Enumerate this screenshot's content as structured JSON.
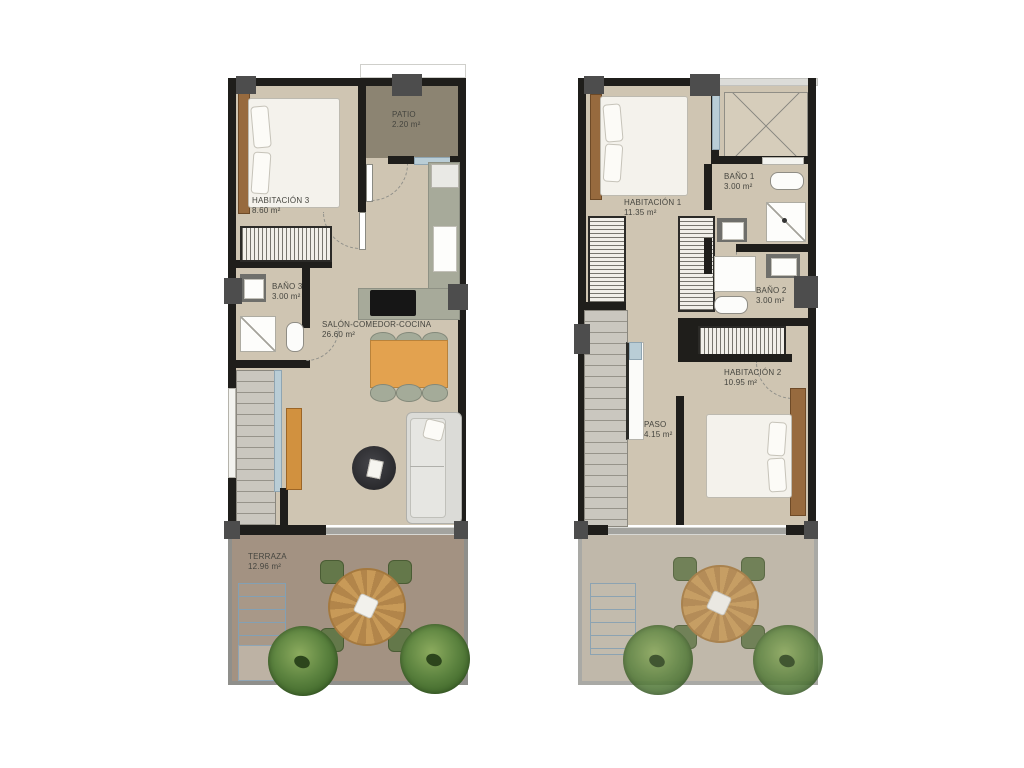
{
  "colors": {
    "background": "#ffffff",
    "wall": "#1f1e1b",
    "pillar": "#4d4d4d",
    "floor": "#cfc5b2",
    "patio_floor": "#8c8472",
    "terrace_floor_ground": "#a39282",
    "terrace_floor_upper": "#c0b8aa",
    "kitchen_counter": "#a7aa9a",
    "dining_table_wood": "#e3a24f",
    "terrace_table_wood": "#c89a58",
    "headboard_wood": "#976a3e",
    "sofa_gray": "#dbdbd7",
    "chair_green": "#64784a",
    "plant_green": "#5d8440",
    "stairs_gray": "#cac7bf",
    "window_blue": "#b9cdd6",
    "label_text": "#45453f"
  },
  "left_plan": {
    "rooms": {
      "habitacion3": {
        "label": "HABITACIÓN 3",
        "area": "8.60 m²"
      },
      "patio": {
        "label": "PATIO",
        "area": "2.20 m²"
      },
      "bano3": {
        "label": "BAÑO 3",
        "area": "3.00 m²"
      },
      "salon": {
        "label": "SALÓN-COMEDOR-COCINA",
        "area": "26.60 m²"
      },
      "terraza": {
        "label": "TERRAZA",
        "area": "12.96 m²"
      }
    }
  },
  "right_plan": {
    "rooms": {
      "habitacion1": {
        "label": "HABITACIÓN 1",
        "area": "11.35 m²"
      },
      "bano1": {
        "label": "BAÑO 1",
        "area": "3.00 m²"
      },
      "bano2": {
        "label": "BAÑO 2",
        "area": "3.00 m²"
      },
      "habitacion2": {
        "label": "HABITACIÓN 2",
        "area": "10.95 m²"
      },
      "paso": {
        "label": "PASO",
        "area": "4.15 m²"
      }
    }
  }
}
